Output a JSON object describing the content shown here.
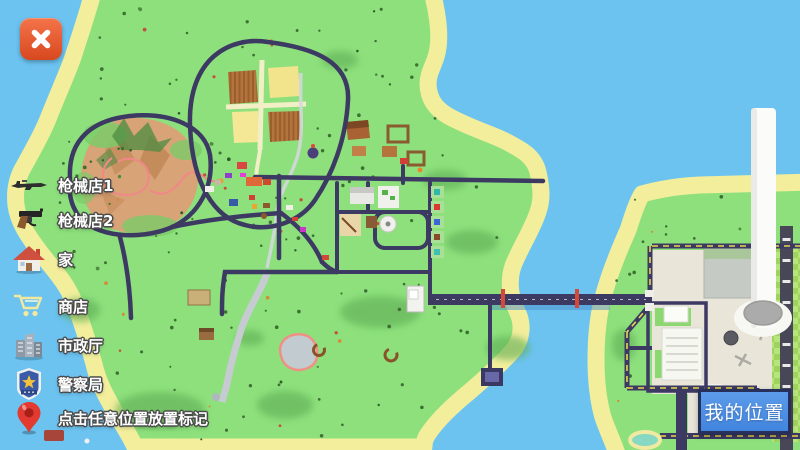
{
  "window": {
    "close_icon": "x-icon"
  },
  "legend": {
    "items": [
      {
        "icon": "rifle-icon",
        "label": "枪械店1"
      },
      {
        "icon": "pistol-icon",
        "label": "枪械店2"
      },
      {
        "icon": "home-icon",
        "label": "家"
      },
      {
        "icon": "cart-icon",
        "label": "商店"
      },
      {
        "icon": "city-hall-icon",
        "label": "市政厅"
      },
      {
        "icon": "police-badge-icon",
        "label": "警察局"
      },
      {
        "icon": "map-pin-icon",
        "label": "点击任意位置放置标记"
      }
    ]
  },
  "map": {
    "my_location_button": "我的位置"
  },
  "colors": {
    "water": "#6CC3F0",
    "grass": "#8DE07C",
    "beach": "#F2EE9C",
    "road": "#3C3963",
    "accent_blue": "#4A8FE2",
    "close_red": "#E1512A",
    "button_border": "#27305A"
  }
}
